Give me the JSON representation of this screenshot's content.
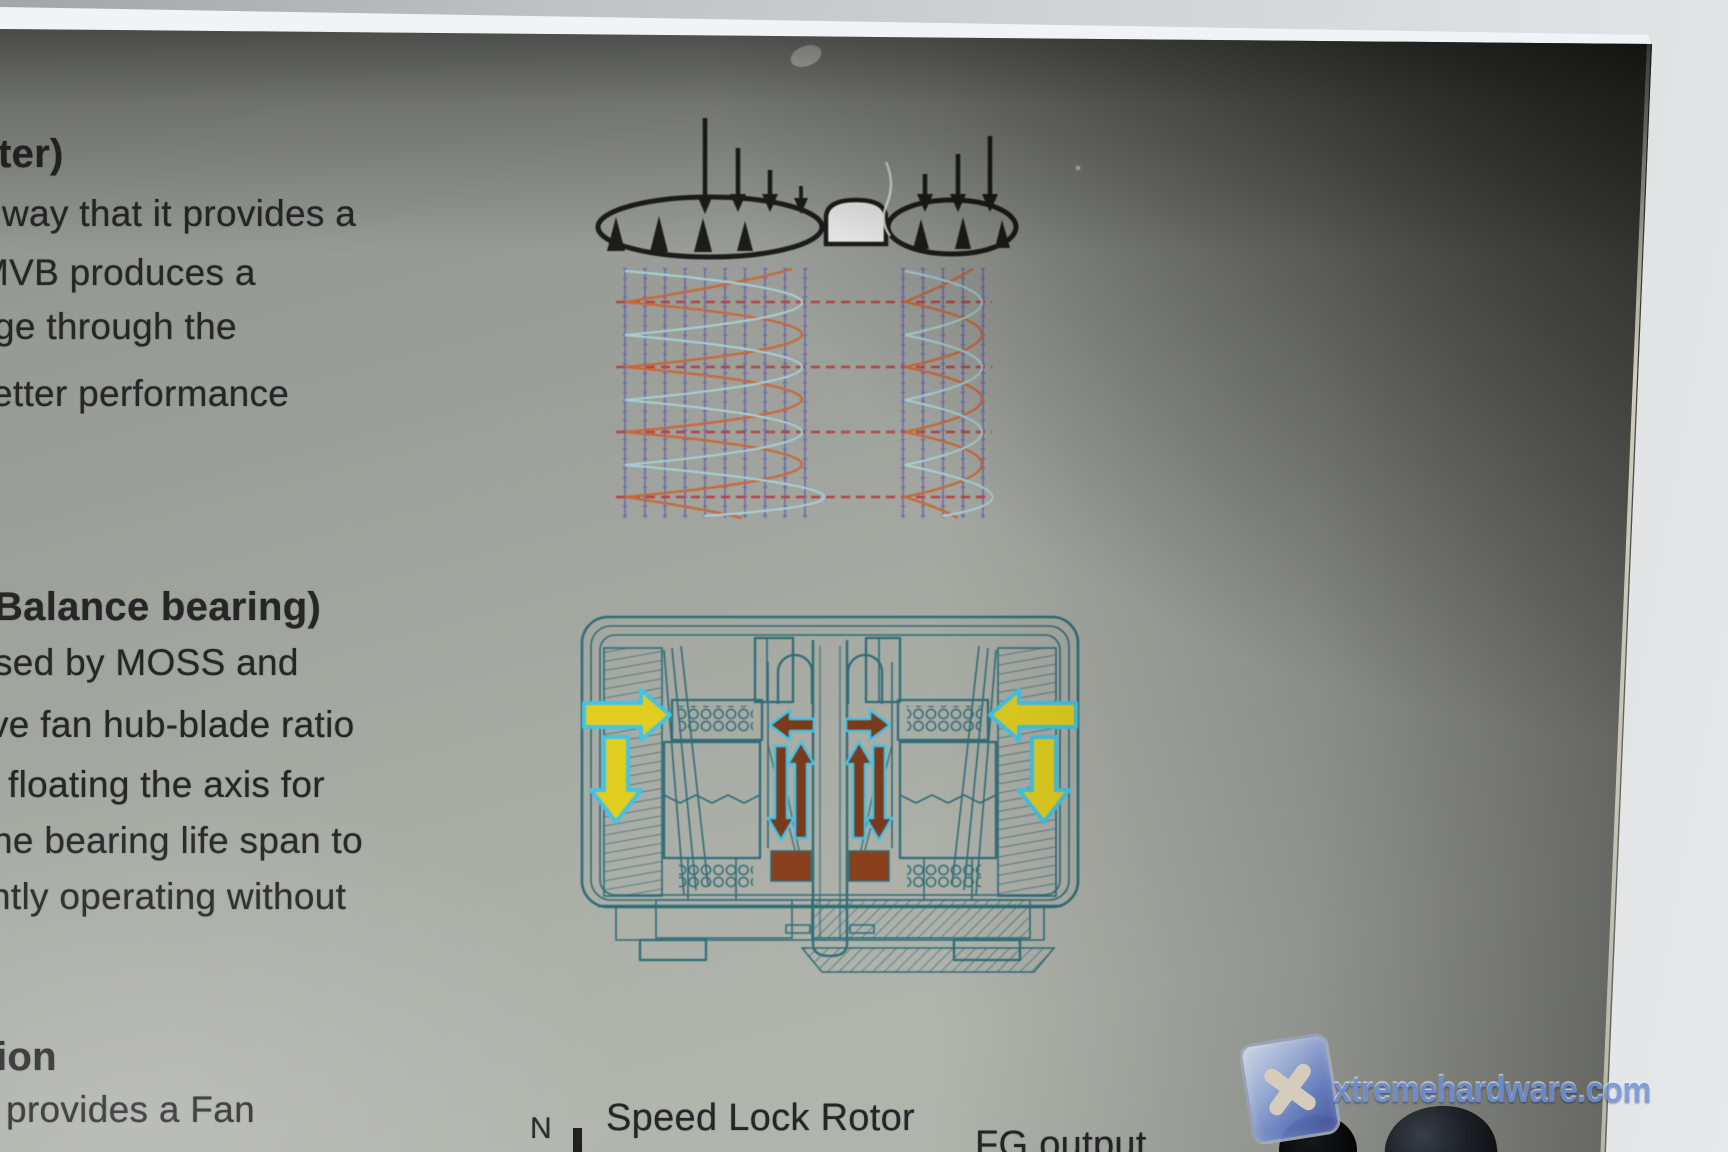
{
  "photo": {
    "box_text": {
      "h1": "ter)",
      "p1l1": "way that it provides a",
      "p1l2": "MVB produces a",
      "p1l3": "ge through the",
      "p1l4": "etter performance",
      "h2": "Balance bearing)",
      "p2l1": "sed by MOSS and",
      "p2l2": "ve fan hub-blade ratio",
      "p2l3": "floating the axis for",
      "p2l4": "he bearing life span to",
      "p2l5": "ntly operating without",
      "h3": "ion",
      "p3l1": "provides a Fan"
    },
    "diagram_labels": {
      "n_pole": "N",
      "speed_lock_rotor": "Speed Lock Rotor",
      "fg_output": "FG output"
    },
    "watermark": {
      "site": "xtremehardware.com"
    },
    "colors": {
      "ink": "#1c1c1a",
      "text_ink": "#262626",
      "teal": "#2e6d75",
      "yellow": "#e0cd20",
      "cyan": "#43c3e6",
      "brown": "#7a3a1c",
      "magnet": "#8a3f1d",
      "orange": "#c8683a",
      "wavecyan": "#a6ced2",
      "red": "#b24343",
      "grid": "#6a6aa8",
      "wmblue": "#6a8fd8"
    }
  }
}
